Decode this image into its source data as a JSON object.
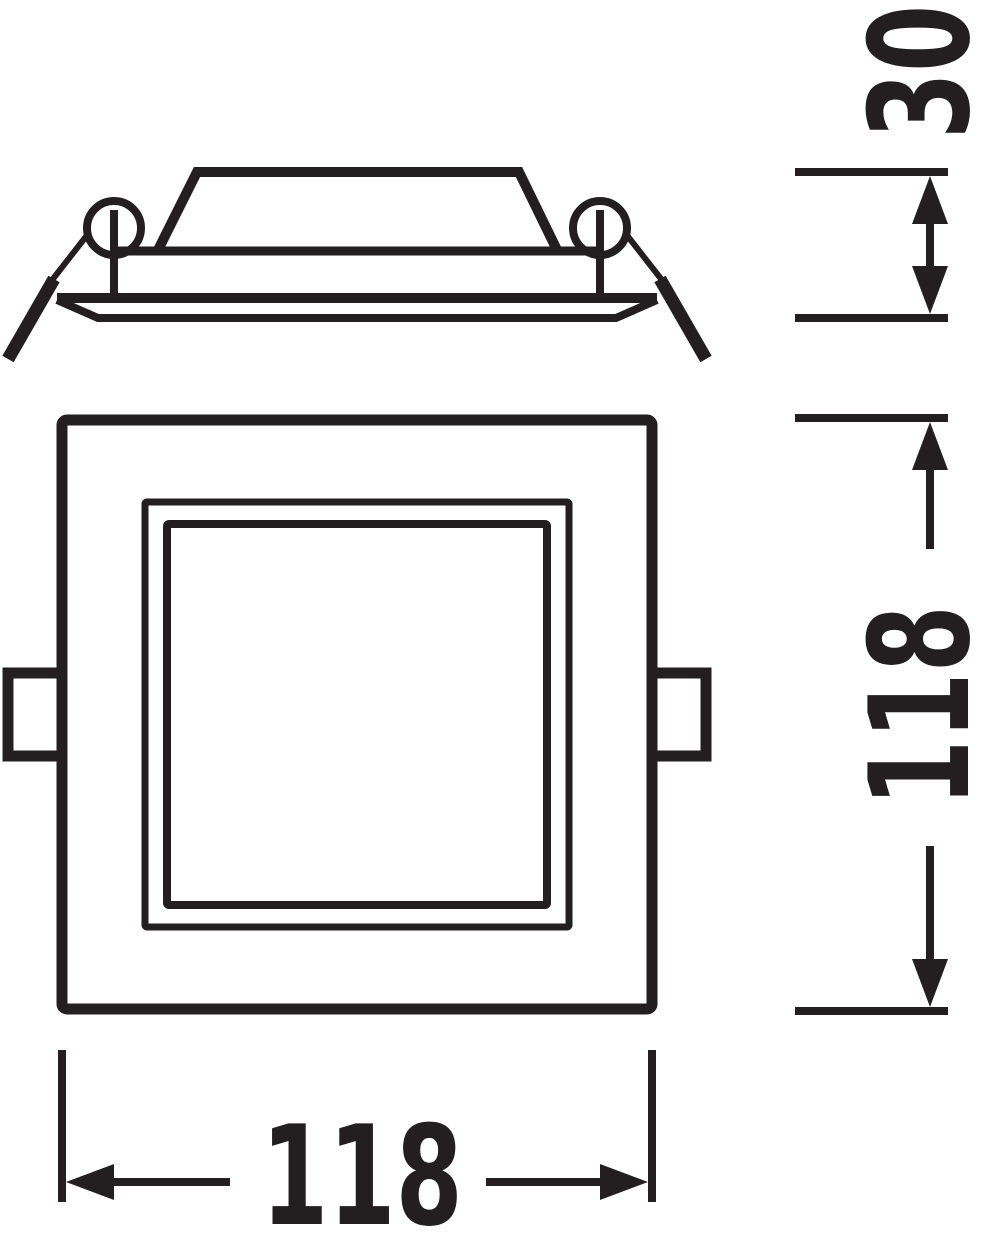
{
  "colors": {
    "ink": "#231f20",
    "background": "#ffffff"
  },
  "views": {
    "side": {
      "name": "side-profile-view"
    },
    "front": {
      "name": "front-view"
    }
  },
  "dimensions": {
    "depth": {
      "label": "30",
      "orientation": "vertical",
      "position": "top-right"
    },
    "height": {
      "label": "118",
      "orientation": "vertical",
      "position": "right"
    },
    "width": {
      "label": "118",
      "orientation": "horizontal",
      "position": "bottom"
    }
  }
}
